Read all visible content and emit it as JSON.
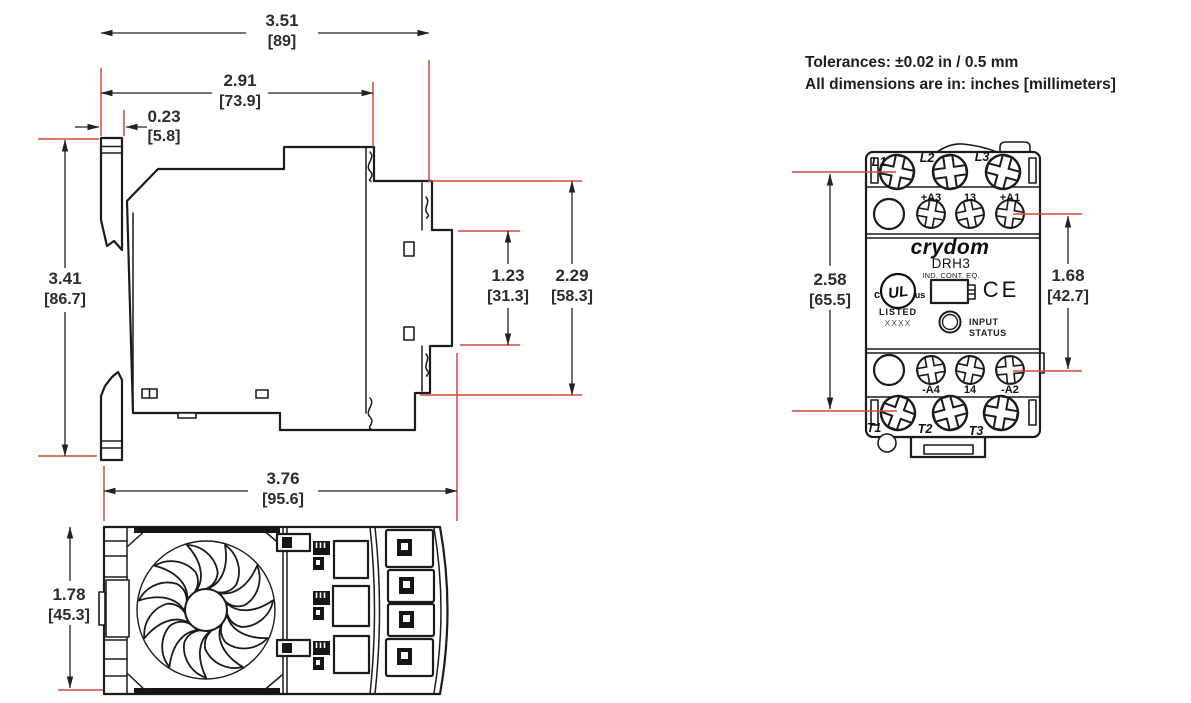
{
  "header": {
    "tolerances": "Tolerances: ±0.02 in / 0.5 mm",
    "units_note": "All dimensions are in: inches [millimeters]"
  },
  "side_view": {
    "overall_width_in": "3.51",
    "overall_width_mm": "[89]",
    "body_width_in": "2.91",
    "body_width_mm": "[73.9]",
    "clip_depth_in": "0.23",
    "clip_depth_mm": "[5.8]",
    "overall_height_in": "3.41",
    "overall_height_mm": "[86.7]",
    "center_section_in": "1.23",
    "center_section_mm": "[31.3]",
    "terminal_span_in": "2.29",
    "terminal_span_mm": "[58.3]"
  },
  "bottom_view": {
    "overall_width_in": "3.76",
    "overall_width_mm": "[95.6]",
    "overall_depth_in": "1.78",
    "overall_depth_mm": "[45.3]"
  },
  "front_view": {
    "brand": "crydom",
    "model": "DRH3",
    "equipment_label": "IND. CONT. EQ.",
    "ul_c": "c",
    "ul_mark": "UL",
    "ul_us": "us",
    "ul_listed": "LISTED",
    "ul_code": "XXXX",
    "ce_mark": "CE",
    "led_label_line1": "INPUT",
    "led_label_line2": "STATUS",
    "line_terminals": [
      "L1",
      "L2",
      "L3"
    ],
    "control_terminals_top": [
      "+A3",
      "13",
      "+A1"
    ],
    "control_terminals_bottom": [
      "-A4",
      "14",
      "-A2"
    ],
    "load_terminals": [
      "T1",
      "T2",
      "T3"
    ],
    "mount_height_in": "2.58",
    "mount_height_mm": "[65.5]",
    "control_span_in": "1.68",
    "control_span_mm": "[42.7]"
  },
  "colors": {
    "drawing_line": "#1b1b1d",
    "dimension_red": "#cf4b38",
    "dimension_text": "#2b2b31"
  }
}
